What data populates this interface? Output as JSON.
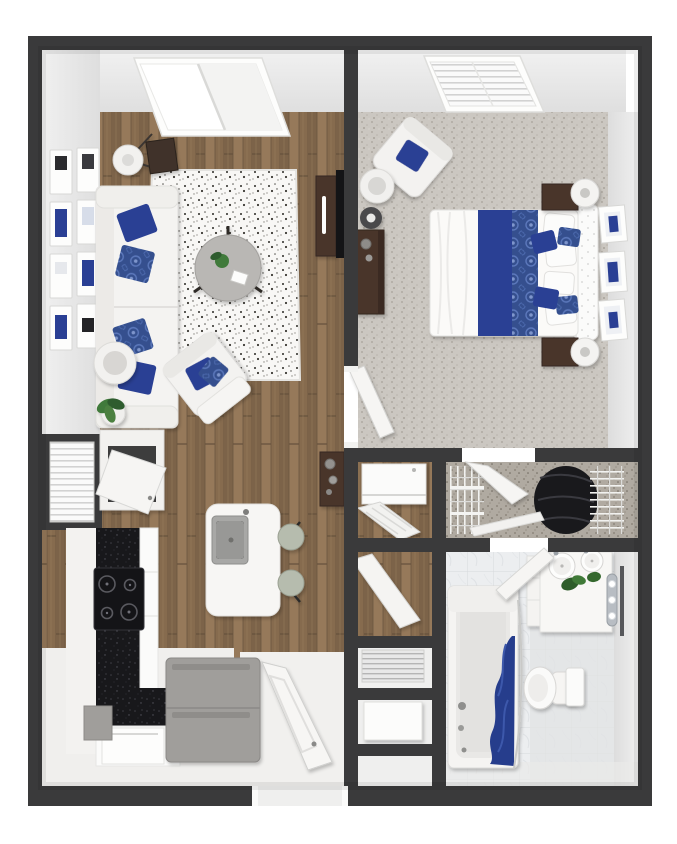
{
  "document": {
    "kind": "3d-floor-plan-top-view",
    "layout": "one-bedroom-one-bath-apartment",
    "background": "white"
  },
  "palette": {
    "page_bg": "#ffffff",
    "wall": "#3a3a3b",
    "wall_face": "#ebebeb",
    "wood_floor": "#8d7154",
    "carpet": "#cbc7c1",
    "closet_carpet": "#b0aaa1",
    "tile": "#eceef0",
    "rug": "#f8f7f5",
    "accent_navy": "#2a3f94",
    "accent_blue_pattern": "#4b6bb4",
    "curtain_navy": "#253c8c",
    "dark_wood": "#49352a",
    "counter_black": "#18181b",
    "stainless": "#a09e9b",
    "appliance_white": "#fcfcfb",
    "plant_green": "#3f7a3a",
    "stool_green": "#b6bcae"
  },
  "rooms": [
    {
      "name": "living-room",
      "floor": "hardwood"
    },
    {
      "name": "kitchen",
      "floor": "hardwood"
    },
    {
      "name": "entry",
      "floor": "light"
    },
    {
      "name": "bedroom",
      "floor": "carpet"
    },
    {
      "name": "walk-in-closet",
      "floor": "carpet"
    },
    {
      "name": "laundry-closet",
      "floor": "hardwood"
    },
    {
      "name": "utility-closets",
      "floor": "light"
    },
    {
      "name": "bathroom",
      "floor": "marble-tile"
    }
  ],
  "furniture": {
    "living_room": [
      "sofa-white",
      "navy-pillows",
      "patterned-blue-pillows",
      "shag-area-rug",
      "round-coffee-table",
      "accent-armchair",
      "floor-lamp",
      "dark-side-table",
      "round-side-table",
      "potted-plant",
      "gallery-wall-frames",
      "tv",
      "tv-console",
      "sliding-window"
    ],
    "gallery_frame_count": 8,
    "kitchen": [
      "l-shaped-counter",
      "black-countertop",
      "cooktop-4-burner",
      "flip-door-wall-cabinet",
      "blinds-window-alcove",
      "island-with-sink",
      "bar-stools",
      "refrigerator",
      "dishwasher"
    ],
    "bar_stool_count": 2,
    "entry": [
      "entry-door",
      "console-table",
      "vases"
    ],
    "bedroom": [
      "bed",
      "tufted-headboard",
      "navy-duvet-band",
      "patterned-runner",
      "pillows",
      "nightstands",
      "table-lamps",
      "dresser",
      "accent-armchair",
      "floor-lamp",
      "round-side-table",
      "wall-frames",
      "blinds-window"
    ],
    "bedroom_wall_frame_count": 3,
    "nightstand_count": 2,
    "walk_in_closet": [
      "wire-shelving",
      "hanging-clothes",
      "closet-door"
    ],
    "laundry_closet": [
      "washer-dryer",
      "louvered-door"
    ],
    "utility": [
      "hvac-grate",
      "water-heater"
    ],
    "bathroom": [
      "bathtub",
      "navy-shower-curtain",
      "curtain-rod",
      "toilet",
      "toilet-tank-cabinet",
      "double-sink-vanity",
      "vanity-plants",
      "vanity-light-bar",
      "mirror",
      "bathroom-door"
    ],
    "vanity_sink_count": 2
  }
}
